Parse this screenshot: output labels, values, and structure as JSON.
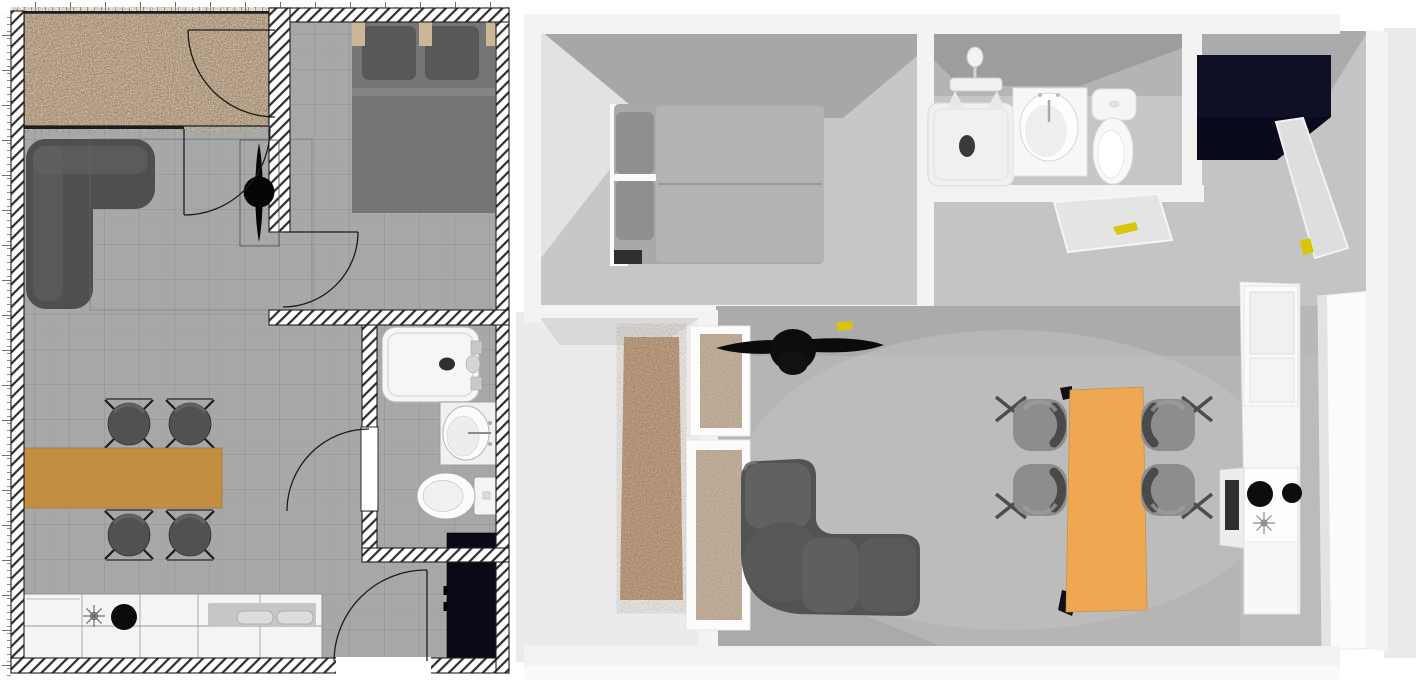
{
  "app": {
    "description": "Home-design application canvas showing the same studio apartment as a 2D plan (left) and a 3D overhead render (right)",
    "panels": {
      "plan_2d": {
        "label": "2D floor plan (top-down, with rulers and hatched walls)",
        "rooms": [
          "entry hall with rug",
          "living / dining room",
          "bedroom",
          "bathroom",
          "kitchen strip"
        ],
        "furniture": [
          "area rug",
          "corner sofa",
          "ceiling fan",
          "double bed with two pillows",
          "dining table",
          "dining chair x4",
          "kitchen counter with cooktop and double sink",
          "refrigerator",
          "bathtub",
          "washbasin",
          "toilet",
          "hinged door x5"
        ]
      },
      "view_3d": {
        "label": "3D aerial view (same apartment rotated 90° counter-clockwise)",
        "furniture": [
          "double bed with two pillows",
          "hall carpet runner",
          "open interior doors",
          "ceiling fan",
          "corner sofa",
          "dining table",
          "dining chair x4",
          "kitchen tall cabinet",
          "cooktop with two burners",
          "oven",
          "refrigerator (dark top)",
          "shower tray",
          "faucet stand",
          "washbasin cabinet",
          "toilet",
          "wardrobe slab"
        ]
      }
    }
  },
  "colors": {
    "white": "#ffffff",
    "plan_floor": "#a8a8a8",
    "rug": "#b49a7c",
    "sofa_2d": "#4f4f4f",
    "bed_2d": "#757575",
    "pillow_2d": "#585858",
    "headboard_wood": "#cbb795",
    "table_2d": "#c28f41",
    "chair_2d": "#515151",
    "counter_2d": "#f4f4f4",
    "sink_inset": "#c6c6c6",
    "fridge_2d": "#0a0a17",
    "fixture_white": "#f6f6f6",
    "door_line": "#1c1c1c",
    "wall_3d": "#f3f3f1",
    "floor_bedroom": "#c7c7c7",
    "floor_living": "#b5b5b5",
    "floor_hall": "#ebebeb",
    "floor_bath": "#b4b4b4",
    "backdrop_3d": "#c4c4c4",
    "shadow_3d": "#a7a7a7",
    "bed_3d": "#a9a9a9",
    "sheet_3d": "#b4b4b4",
    "pillow_3d": "#8f8f8f",
    "sofa_3d": "#535353",
    "table_3d": "#eea851",
    "chair_3d": "#8d8d8d",
    "chair_back_3d": "#4a4a4a",
    "carpet_3d": "#b08c6d",
    "door_panel_3d": "#b4a18c",
    "fridge_3d": "#0a0a1e",
    "door_open_3d": "#e4e4e4",
    "handle_yellow": "#d9c504",
    "kitchen_white": "#f7f7f6",
    "burner": "#0d0d0d",
    "exterior_3d": "#eaeaea"
  }
}
